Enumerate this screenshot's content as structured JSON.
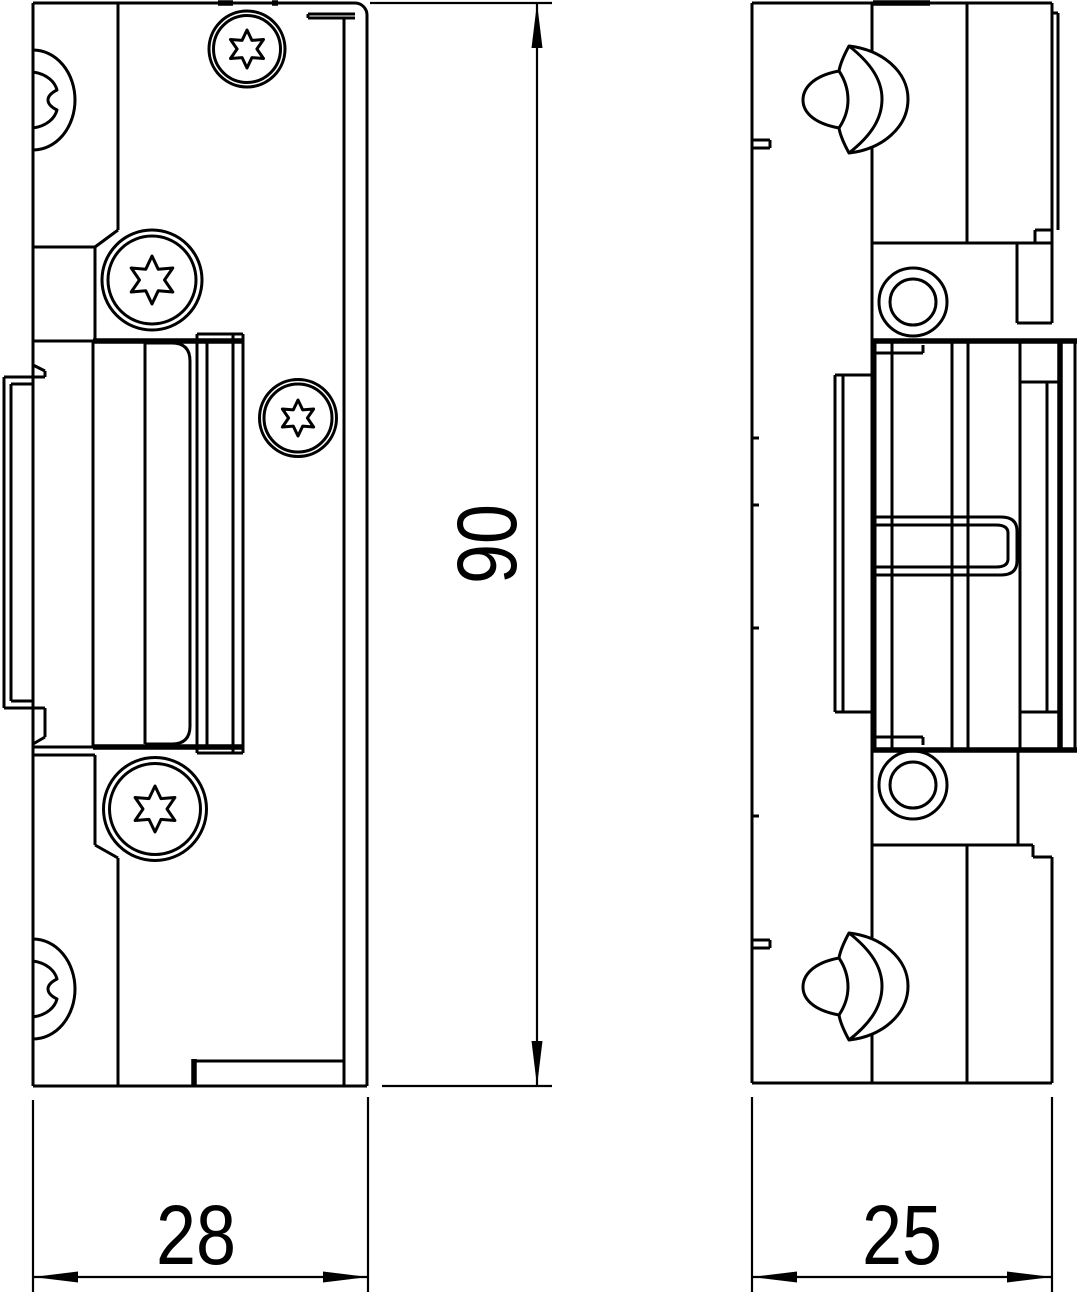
{
  "drawing": {
    "background_color": "#ffffff",
    "line_color": "#000000",
    "dimensions": {
      "front_width": {
        "value": "28"
      },
      "front_height": {
        "value": "90"
      },
      "side_width": {
        "value": "25"
      }
    }
  }
}
